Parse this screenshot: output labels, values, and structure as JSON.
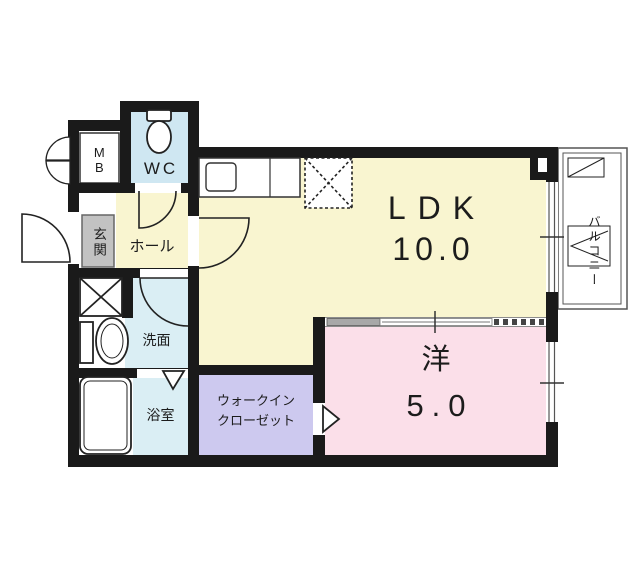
{
  "floorplan": {
    "title": "1LDK apartment floor plan",
    "rooms": {
      "ldk": {
        "name": "LDK",
        "area": "10.0",
        "color": "#f9f5d0"
      },
      "western": {
        "name": "洋",
        "area": "5.0",
        "color": "#fbdfe9"
      },
      "wic": {
        "line1": "ウォークイン",
        "line2": "クローゼット",
        "color": "#cdc9ef"
      },
      "hall": {
        "name": "ホール",
        "color": "#f9f5d0"
      },
      "entrance": {
        "name": "玄関",
        "color": "#c2c2c2"
      },
      "wc": {
        "name": "WC",
        "color": "#cfe7f2"
      },
      "washroom": {
        "name": "洗面",
        "color": "#daeef4"
      },
      "bathroom": {
        "name": "浴室",
        "color": "#daeef4"
      },
      "meter_box": {
        "name": "MB",
        "color": "#ffffff"
      },
      "balcony": {
        "name": "バルコニー",
        "color": "#ffffff"
      }
    },
    "colors": {
      "wall": "#1a1a1a",
      "background": "#ffffff",
      "fixture_stroke": "#222222",
      "balcony_line": "#555555"
    }
  }
}
